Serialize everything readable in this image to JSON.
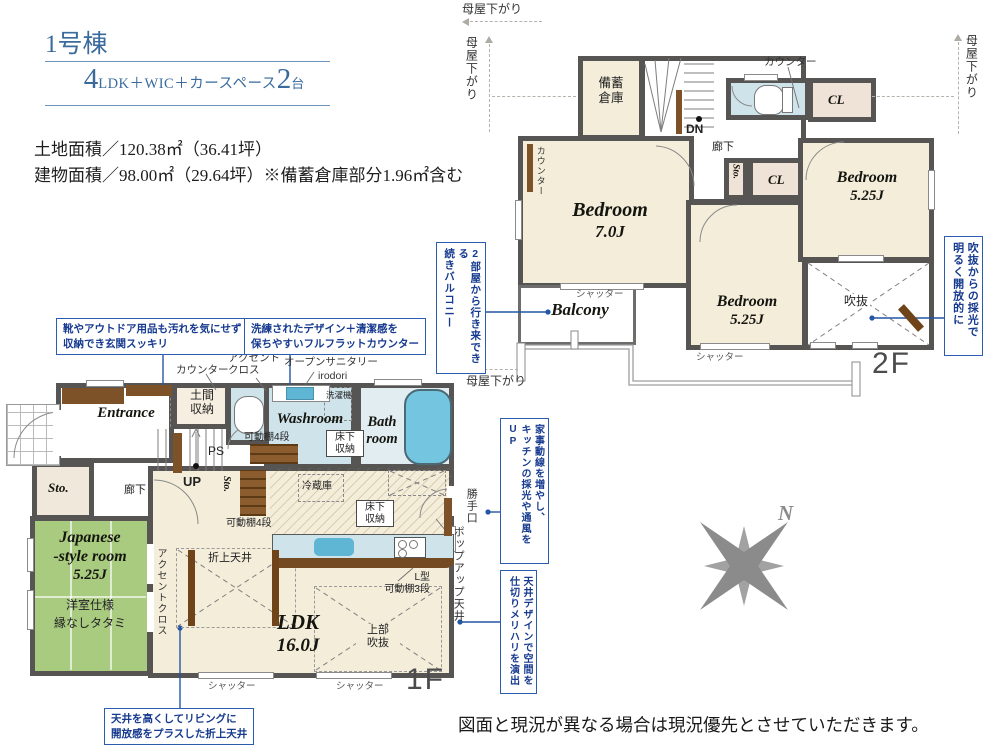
{
  "header": {
    "building": "1号棟",
    "plan_big1": "4",
    "plan_mid": "LDK＋WIC＋カースペース",
    "plan_big2": "2",
    "plan_tail": "台",
    "land_area": "土地面積／120.38㎡（36.41坪）",
    "building_area": "建物面積／98.00㎡（29.64坪）※備蓄倉庫部分1.96㎡含む"
  },
  "common": {
    "moyasagari": "母屋下がり",
    "shutter": "シャッター",
    "counter": "カウンター",
    "corridor": "廊下",
    "cl": "CL",
    "sto": "Sto.",
    "kadoudana4": "可動棚4段",
    "yukashita": "床下\n収納"
  },
  "floor2": {
    "label": "2F",
    "bichiku": "備蓄\n倉庫",
    "dn": "DN",
    "bedroom7": {
      "name": "Bedroom",
      "size": "7.0J"
    },
    "bedroom5m": {
      "name": "Bedroom",
      "size": "5.25J"
    },
    "bedroom5r": {
      "name": "Bedroom",
      "size": "5.25J"
    },
    "fukinuke": "吹抜",
    "balcony": "Balcony",
    "callout_balcony": {
      "l1": "2部屋から行き来できる",
      "l2": "続きバルコニー"
    },
    "callout_light": {
      "l1": "吹抜からの採光で",
      "l2": "明るく開放的に"
    }
  },
  "floor1": {
    "label": "1F",
    "entrance": "Entrance",
    "doma": "土間\n収納",
    "ps": "PS",
    "up": "UP",
    "washroom": "Washroom",
    "washer": "洗濯機",
    "bathroom": "Bath\nroom",
    "fridge": "冷蔵庫",
    "ldk": {
      "name": "LDK",
      "size": "16.0J"
    },
    "orie_ceiling": "折上天井",
    "upper_void": "上部\n吹抜",
    "lshelf": "L型\n可動棚3段",
    "jroom": {
      "l1": "Japanese",
      "l2": "-style room",
      "l3": "5.25J",
      "note1": "洋室仕様",
      "note2": "縁なしタタミ"
    },
    "accent_v": "アクセントクロス",
    "accent2": "アクセント\nクロス",
    "open_sanitary": "オープンサニタリー",
    "irodori": "irodori",
    "katteguchi": "勝手口",
    "popup": "ポップアップ天井",
    "callout_shoes": "靴やアウトドア用品も汚れを気にせず\n収納でき玄関スッキリ",
    "callout_counter": "洗練されたデザイン＋清潔感を\n保ちやすいフルフラットカウンター",
    "callout_kaji": {
      "l1": "家事動線を増やし、",
      "l2": "キッチンの採光や通風をUP"
    },
    "callout_ceiling": {
      "l1": "天井デザインで空間を",
      "l2": "仕切りメリハリを演出"
    },
    "callout_orie": "天井を高くしてリビングに\n開放感をプラスした折上天井"
  },
  "compass": {
    "n": "N"
  },
  "footer": "図面と現況が異なる場合は現況優先とさせていただきます。"
}
